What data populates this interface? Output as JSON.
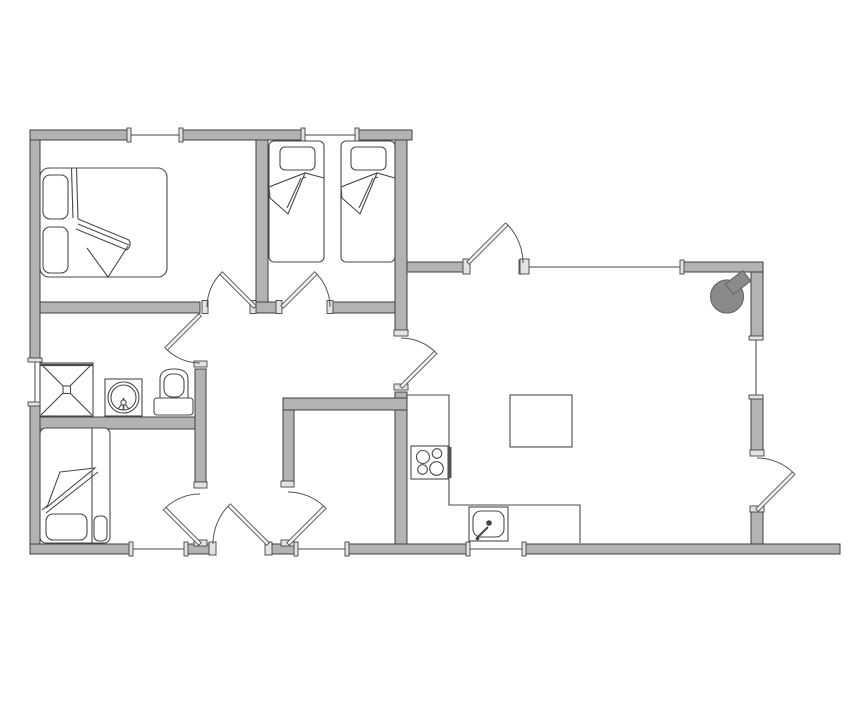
{
  "meta": {
    "title": "cottage-floor-plan"
  },
  "palette": {
    "background": "#ffffff",
    "wall_fill": "#b3b3b3",
    "wall_stroke": "#3f3f3f",
    "plug_fill": "#e3e3e3",
    "plug_stroke": "#444444",
    "window_line": "#444444",
    "door_arc": "#555555",
    "door_leaf_fill": "#f2f2f2",
    "furniture_stroke": "#4a4a4a",
    "stove_fill": "#8a8a8a",
    "stove_stroke": "#6b6b6b"
  },
  "plan": {
    "width": 855,
    "height": 714,
    "wall_thickness": 10,
    "walls": [
      {
        "name": "wall-top-a",
        "x": 30,
        "y": 130,
        "w": 101,
        "h": 10
      },
      {
        "name": "wall-top-b",
        "x": 179,
        "y": 130,
        "w": 126,
        "h": 10
      },
      {
        "name": "wall-top-c",
        "x": 355,
        "y": 130,
        "w": 57,
        "h": 10
      },
      {
        "name": "wall-left-upper",
        "x": 30,
        "y": 140,
        "w": 10,
        "h": 222
      },
      {
        "name": "wall-left-lower",
        "x": 30,
        "y": 402,
        "w": 10,
        "h": 142
      },
      {
        "name": "wall-bottom-a",
        "x": 30,
        "y": 544,
        "w": 103,
        "h": 10
      },
      {
        "name": "wall-bottom-b",
        "x": 184,
        "y": 544,
        "w": 29,
        "h": 10
      },
      {
        "name": "wall-bottom-c",
        "x": 268,
        "y": 544,
        "w": 30,
        "h": 10
      },
      {
        "name": "wall-bottom-d",
        "x": 345,
        "y": 544,
        "w": 125,
        "h": 10
      },
      {
        "name": "wall-bottom-e",
        "x": 522,
        "y": 544,
        "w": 318,
        "h": 10
      },
      {
        "name": "wall-right-upper",
        "x": 751,
        "y": 262,
        "w": 12,
        "h": 78
      },
      {
        "name": "wall-right-mid",
        "x": 751,
        "y": 395,
        "w": 12,
        "h": 60
      },
      {
        "name": "wall-right-stub",
        "x": 751,
        "y": 510,
        "w": 12,
        "h": 34
      },
      {
        "name": "wall-living-north-a",
        "x": 405,
        "y": 262,
        "w": 60,
        "h": 10
      },
      {
        "name": "wall-living-north-b",
        "x": 680,
        "y": 262,
        "w": 83,
        "h": 10
      },
      {
        "name": "wall-bedrooms-south-a",
        "x": 40,
        "y": 302,
        "w": 160,
        "h": 11
      },
      {
        "name": "wall-bedrooms-south-pillar",
        "x": 255,
        "y": 302,
        "w": 26,
        "h": 11
      },
      {
        "name": "wall-bedrooms-south-b",
        "x": 330,
        "y": 302,
        "w": 77,
        "h": 11
      },
      {
        "name": "wall-bedroom-divider",
        "x": 256,
        "y": 140,
        "w": 12,
        "h": 162
      },
      {
        "name": "wall-twin-east-upper",
        "x": 395,
        "y": 140,
        "w": 12,
        "h": 190
      },
      {
        "name": "wall-kitchen-west",
        "x": 395,
        "y": 392,
        "w": 12,
        "h": 152
      },
      {
        "name": "wall-utility-north",
        "x": 283,
        "y": 398,
        "w": 124,
        "h": 12
      },
      {
        "name": "wall-utility-west",
        "x": 283,
        "y": 410,
        "w": 11,
        "h": 72
      },
      {
        "name": "wall-bath-east",
        "x": 195,
        "y": 369,
        "w": 11,
        "h": 113
      },
      {
        "name": "wall-bath-south",
        "x": 40,
        "y": 417,
        "w": 155,
        "h": 12
      }
    ],
    "windows": [
      {
        "name": "window-bedroom1-north",
        "orient": "h",
        "x": 131,
        "y": 130,
        "len": 48
      },
      {
        "name": "window-twinroom-north",
        "orient": "h",
        "x": 305,
        "y": 130,
        "len": 50
      },
      {
        "name": "window-bathroom-west",
        "orient": "v",
        "x": 30,
        "y": 362,
        "len": 40
      },
      {
        "name": "window-bedroom3-south",
        "orient": "h",
        "x": 133,
        "y": 544,
        "len": 51
      },
      {
        "name": "window-utility-south",
        "orient": "h",
        "x": 298,
        "y": 544,
        "len": 47
      },
      {
        "name": "window-kitchen-south",
        "orient": "h",
        "x": 470,
        "y": 544,
        "len": 52
      },
      {
        "name": "window-living-north",
        "orient": "h",
        "x": 523,
        "y": 262,
        "len": 157
      },
      {
        "name": "window-living-east",
        "orient": "v",
        "x": 751,
        "y": 340,
        "len": 55
      }
    ],
    "plugs": [
      {
        "name": "jamb-bedroom1-left",
        "x": 202,
        "y": 300.5,
        "w": 6,
        "h": 13
      },
      {
        "name": "jamb-bedroom1-hinge",
        "x": 250,
        "y": 300.5,
        "w": 6,
        "h": 13
      },
      {
        "name": "jamb-twin-hinge",
        "x": 276,
        "y": 300.5,
        "w": 6,
        "h": 13
      },
      {
        "name": "jamb-twin-right",
        "x": 327,
        "y": 300.5,
        "w": 6,
        "h": 13
      },
      {
        "name": "jamb-bathroom-bottom",
        "x": 194,
        "y": 361,
        "w": 13,
        "h": 6
      },
      {
        "name": "jamb-bedroom3-top",
        "x": 194,
        "y": 482,
        "w": 13,
        "h": 6
      },
      {
        "name": "jamb-bedroom3-hinge",
        "x": 194,
        "y": 540,
        "w": 13,
        "h": 6
      },
      {
        "name": "jamb-entry-left",
        "x": 209,
        "y": 542,
        "w": 7,
        "h": 13
      },
      {
        "name": "jamb-entry-hinge",
        "x": 265,
        "y": 542,
        "w": 7,
        "h": 13
      },
      {
        "name": "jamb-utility-top",
        "x": 281,
        "y": 481,
        "w": 13,
        "h": 6
      },
      {
        "name": "jamb-utility-hinge",
        "x": 281,
        "y": 540,
        "w": 13,
        "h": 6
      },
      {
        "name": "jamb-hall-living-top",
        "x": 394,
        "y": 330,
        "w": 14,
        "h": 6
      },
      {
        "name": "jamb-hall-living-bottom",
        "x": 394,
        "y": 384,
        "w": 14,
        "h": 6
      },
      {
        "name": "jamb-livingdoor-hinge",
        "x": 463,
        "y": 259,
        "w": 7,
        "h": 15
      },
      {
        "name": "jamb-livingdoor-stop",
        "x": 520,
        "y": 259,
        "w": 9,
        "h": 15
      },
      {
        "name": "jamb-backdoor-top",
        "x": 750,
        "y": 450,
        "w": 14,
        "h": 6
      },
      {
        "name": "jamb-backdoor-hinge",
        "x": 750,
        "y": 506,
        "w": 14,
        "h": 6
      }
    ],
    "doors": [
      {
        "name": "door-bedroom1",
        "hinge": [
          255,
          307
        ],
        "r": 48,
        "a0": 180,
        "a1": 225
      },
      {
        "name": "door-twinroom",
        "hinge": [
          282,
          307
        ],
        "r": 48,
        "a0": 0,
        "a1": -45
      },
      {
        "name": "door-bathroom",
        "hinge": [
          200,
          315
        ],
        "r": 48,
        "a0": 90,
        "a1": 135
      },
      {
        "name": "door-bedroom3",
        "hinge": [
          200,
          544
        ],
        "r": 50,
        "a0": 270,
        "a1": 225
      },
      {
        "name": "door-entry",
        "hinge": [
          268,
          544
        ],
        "r": 55,
        "a0": 180,
        "a1": 225
      },
      {
        "name": "door-utility",
        "hinge": [
          288,
          544
        ],
        "r": 52,
        "a0": 270,
        "a1": 315
      },
      {
        "name": "door-hall-living",
        "hinge": [
          401,
          387
        ],
        "r": 49,
        "a0": 270,
        "a1": 315
      },
      {
        "name": "door-living-north",
        "hinge": [
          468,
          263
        ],
        "r": 55,
        "a0": 0,
        "a1": -45
      },
      {
        "name": "door-living-east",
        "hinge": [
          757,
          510
        ],
        "r": 52,
        "a0": 270,
        "a1": 315
      }
    ],
    "furniture": [
      {
        "type": "rect",
        "name": "bed1-frame",
        "x": 40,
        "y": 168,
        "w": 127,
        "h": 109,
        "rx": 9,
        "fill": "#ffffff"
      },
      {
        "type": "rect",
        "name": "bed1-pillow-top",
        "x": 43,
        "y": 175,
        "w": 25,
        "h": 44,
        "rx": 7
      },
      {
        "type": "rect",
        "name": "bed1-pillow-bottom",
        "x": 43,
        "y": 227,
        "w": 25,
        "h": 46,
        "rx": 7
      },
      {
        "type": "line",
        "name": "bed1-duvet-edge",
        "x1": 71.5,
        "y1": 168,
        "x2": 73,
        "y2": 218
      },
      {
        "type": "line",
        "name": "bed1-duvet-edge",
        "x1": 76.5,
        "y1": 168,
        "x2": 78,
        "y2": 219
      },
      {
        "type": "path",
        "name": "bed1-duvet-fold",
        "d": "M78,219 L129,240 M78,224 L129,245 M76,229 L127,250 M129,240 Q132,245 127,250"
      },
      {
        "type": "path",
        "name": "bed1-duvet-flap",
        "d": "M87,248 L108,277 L128,246"
      },
      {
        "type": "rect",
        "name": "bed2a-frame",
        "x": 269,
        "y": 141,
        "w": 55,
        "h": 121,
        "rx": 5,
        "fill": "#ffffff"
      },
      {
        "type": "rect",
        "name": "bed2a-pillow",
        "x": 280,
        "y": 147,
        "w": 35,
        "h": 23,
        "rx": 5
      },
      {
        "type": "path",
        "name": "bed2a-duvet",
        "d": "M269,187 L305,173 L324,178 M269,191 L306,177"
      },
      {
        "type": "path",
        "name": "bed2a-flap",
        "d": "M305,173 L288,214 L270,198 L269,187 Z",
        "fill": "#ffffff"
      },
      {
        "type": "line",
        "name": "bed2a-flap-line",
        "x1": 301,
        "y1": 178,
        "x2": 287,
        "y2": 208
      },
      {
        "type": "rect",
        "name": "bed2b-frame",
        "x": 341,
        "y": 141,
        "w": 54,
        "h": 121,
        "rx": 5,
        "fill": "#ffffff"
      },
      {
        "type": "rect",
        "name": "bed2b-pillow",
        "x": 351,
        "y": 147,
        "w": 35,
        "h": 23,
        "rx": 5
      },
      {
        "type": "path",
        "name": "bed2b-duvet",
        "d": "M341,187 L377,173 L395,178 M341,191 L378,177"
      },
      {
        "type": "path",
        "name": "bed2b-flap",
        "d": "M377,173 L360,214 L342,198 L341,187 Z",
        "fill": "#ffffff"
      },
      {
        "type": "line",
        "name": "bed2b-flap-line",
        "x1": 373,
        "y1": 178,
        "x2": 359,
        "y2": 208
      },
      {
        "type": "rect",
        "name": "shower-tray",
        "x": 40,
        "y": 363,
        "w": 53,
        "h": 53,
        "fill": "#ffffff"
      },
      {
        "type": "line",
        "name": "shower-edge",
        "x1": 40,
        "y1": 365,
        "x2": 93,
        "y2": 365,
        "sw": 2.2
      },
      {
        "type": "line",
        "name": "shower-diagonal",
        "x1": 41,
        "y1": 364,
        "x2": 92,
        "y2": 415
      },
      {
        "type": "line",
        "name": "shower-diagonal",
        "x1": 92,
        "y1": 364,
        "x2": 41,
        "y2": 415
      },
      {
        "type": "rect",
        "name": "shower-drain",
        "x": 63,
        "y": 386,
        "w": 7.5,
        "h": 7.5,
        "fill": "#ffffff"
      },
      {
        "type": "rect",
        "name": "washbasin-stand",
        "x": 105,
        "y": 379,
        "w": 37,
        "h": 37,
        "fill": "#ffffff"
      },
      {
        "type": "circle",
        "name": "washbasin-outer",
        "cx": 123.5,
        "cy": 397.5,
        "r": 15.5
      },
      {
        "type": "circle",
        "name": "washbasin-inner",
        "cx": 123.5,
        "cy": 397.5,
        "r": 12.5
      },
      {
        "type": "line",
        "name": "washbasin-tap",
        "x1": 123.5,
        "y1": 398,
        "x2": 123.5,
        "y2": 410,
        "sw": 1.6
      },
      {
        "type": "circle",
        "name": "washbasin-tap-knob",
        "cx": 123.5,
        "cy": 402.5,
        "r": 2.6,
        "fill": "#ffffff"
      },
      {
        "type": "line",
        "name": "washbasin-tick",
        "x1": 118,
        "y1": 409,
        "x2": 121.5,
        "y2": 404.5
      },
      {
        "type": "line",
        "name": "washbasin-tick",
        "x1": 129,
        "y1": 409,
        "x2": 125.5,
        "y2": 404.5
      },
      {
        "type": "path",
        "name": "toilet-bowl",
        "d": "M160,401 L160,379 Q160,369 174,369 Q188,369 188,379 L188,401 Z",
        "fill": "#ffffff"
      },
      {
        "type": "rect",
        "name": "toilet-seat",
        "x": 164,
        "y": 374,
        "w": 20,
        "h": 23,
        "rx": 8,
        "fill": "#ffffff"
      },
      {
        "type": "rect",
        "name": "toilet-tank",
        "x": 154,
        "y": 398,
        "w": 39,
        "h": 17,
        "rx": 3,
        "fill": "#ffffff"
      },
      {
        "type": "rect",
        "name": "bed3-frame",
        "x": 40,
        "y": 428,
        "w": 70,
        "h": 115,
        "rx": 6,
        "fill": "#ffffff"
      },
      {
        "type": "line",
        "name": "bed3-divider",
        "x1": 92,
        "y1": 428,
        "x2": 92,
        "y2": 543
      },
      {
        "type": "line",
        "name": "bed3-fold-line",
        "x1": 42,
        "y1": 510,
        "x2": 95,
        "y2": 468
      },
      {
        "type": "line",
        "name": "bed3-fold-line",
        "x1": 46,
        "y1": 513,
        "x2": 98,
        "y2": 472
      },
      {
        "type": "path",
        "name": "bed3-flap",
        "d": "M60,472 L95,468 L47,507 Z",
        "fill": "#ffffff"
      },
      {
        "type": "rect",
        "name": "bed3-pillow",
        "x": 46,
        "y": 514,
        "w": 41,
        "h": 26,
        "rx": 7
      },
      {
        "type": "rect",
        "name": "bed3-pillow-small",
        "x": 94,
        "y": 516,
        "w": 13,
        "h": 25,
        "rx": 5
      },
      {
        "type": "path",
        "name": "kitchen-counter",
        "d": "M407,395 L449,395 L449,505 L580,505 L580,543"
      },
      {
        "type": "rect",
        "name": "cooktop",
        "x": 411,
        "y": 446,
        "w": 37,
        "h": 33,
        "fill": "#ffffff"
      },
      {
        "type": "rect",
        "name": "cooktop-panel",
        "x": 447.5,
        "y": 447,
        "w": 4,
        "h": 31,
        "fill": "#555555",
        "sw": 0
      },
      {
        "type": "circle",
        "name": "cooktop-burner",
        "cx": 423,
        "cy": 457,
        "r": 6.5
      },
      {
        "type": "circle",
        "name": "cooktop-burner",
        "cx": 437,
        "cy": 453.5,
        "r": 4.8
      },
      {
        "type": "circle",
        "name": "cooktop-burner",
        "cx": 422.5,
        "cy": 469.5,
        "r": 4.8
      },
      {
        "type": "circle",
        "name": "cooktop-burner",
        "cx": 436.5,
        "cy": 468.5,
        "r": 6.8
      },
      {
        "type": "rect",
        "name": "sink-counter",
        "x": 469,
        "y": 507,
        "w": 39,
        "h": 34,
        "fill": "#ffffff"
      },
      {
        "type": "rect",
        "name": "sink-basin",
        "x": 473,
        "y": 511,
        "w": 31,
        "h": 26,
        "rx": 8
      },
      {
        "type": "circle",
        "name": "sink-drain",
        "cx": 489,
        "cy": 523,
        "r": 2.8,
        "fill": "#444444",
        "sw": 0
      },
      {
        "type": "line",
        "name": "sink-tap",
        "x1": 477,
        "y1": 538,
        "x2": 488,
        "y2": 527,
        "sw": 2
      },
      {
        "type": "circle",
        "name": "sink-tap-base",
        "cx": 477.5,
        "cy": 538.5,
        "r": 1.8,
        "fill": "#444444",
        "sw": 0
      },
      {
        "type": "rect",
        "name": "dining-table",
        "x": 510,
        "y": 395,
        "w": 62,
        "h": 52,
        "fill": "#ffffff"
      },
      {
        "type": "circle",
        "name": "wood-stove",
        "cx": 727,
        "cy": 296.5,
        "r": 16.5,
        "fill": "#8a8a8a",
        "stroke": "#6b6b6b",
        "sw": 1.2
      },
      {
        "type": "rect",
        "name": "wood-stove-chimney",
        "x": 727,
        "y": 276,
        "w": 22,
        "h": 13,
        "fill": "#8a8a8a",
        "stroke": "#6b6b6b",
        "sw": 1.2,
        "rotate": [
          -38,
          738,
          282.5
        ]
      }
    ]
  }
}
